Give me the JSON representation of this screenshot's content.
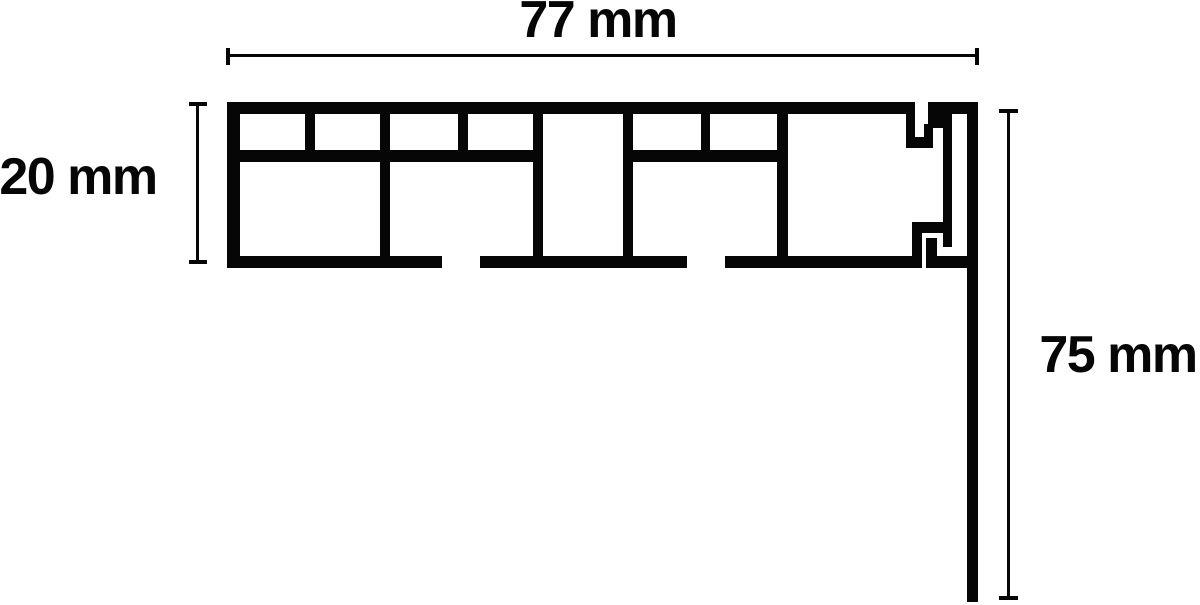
{
  "drawing": {
    "type": "technical-cross-section",
    "units": "mm",
    "ink": "#060606",
    "bg": "#ffffff",
    "profile_rects": [
      [
        227,
        102,
        688,
        12,
        "top-wall"
      ],
      [
        227,
        102,
        13,
        166,
        "left-wall"
      ],
      [
        240,
        150,
        293,
        12,
        "middle-wall-segment-1"
      ],
      [
        633,
        150,
        144,
        12,
        "middle-wall-segment-2"
      ],
      [
        227,
        256,
        215,
        12,
        "bottom-wall-segment-1"
      ],
      [
        480,
        256,
        207,
        12,
        "bottom-wall-segment-2"
      ],
      [
        725,
        256,
        197,
        12,
        "bottom-wall-segment-3"
      ],
      [
        926,
        256,
        52,
        12,
        "bottom-wall-segment-4"
      ],
      [
        305,
        114,
        10,
        48,
        "top-row-divider-1"
      ],
      [
        380,
        114,
        10,
        142,
        "full-divider-1"
      ],
      [
        458,
        114,
        10,
        48,
        "top-row-divider-2"
      ],
      [
        533,
        114,
        10,
        142,
        "center-channel-wall-left"
      ],
      [
        623,
        114,
        10,
        142,
        "center-channel-wall-right"
      ],
      [
        701,
        114,
        9,
        48,
        "top-row-divider-3"
      ],
      [
        777,
        114,
        11,
        142,
        "full-divider-2"
      ],
      [
        906,
        114,
        9,
        34,
        "hook-top-leg"
      ],
      [
        906,
        137,
        27,
        11,
        "hook-top-ledge"
      ],
      [
        924,
        124,
        9,
        24,
        "hook-up-bar"
      ],
      [
        928,
        102,
        24,
        26,
        "end-cap-block"
      ],
      [
        928,
        102,
        50,
        12,
        "end-cap-top-wall"
      ],
      [
        943,
        126,
        9,
        121,
        "end-cap-inner-bar"
      ],
      [
        967,
        114,
        11,
        488,
        "side-panel-descender"
      ],
      [
        912,
        222,
        10,
        46,
        "foot-step"
      ],
      [
        912,
        222,
        40,
        11,
        "foot-ledge"
      ],
      [
        926,
        238,
        11,
        18,
        "foot-stub"
      ]
    ],
    "dimension_rects": [
      [
        227,
        54,
        751,
        3,
        "width-dim-line"
      ],
      [
        226,
        48,
        4,
        17,
        "width-dim-tick-left"
      ],
      [
        975,
        48,
        4,
        17,
        "width-dim-tick-right"
      ],
      [
        196,
        104,
        3,
        158,
        "height-dim-line"
      ],
      [
        189,
        102,
        18,
        4,
        "height-dim-tick-top"
      ],
      [
        189,
        260,
        18,
        4,
        "height-dim-tick-bottom"
      ],
      [
        1007,
        111,
        3,
        487,
        "drop-dim-line"
      ],
      [
        999,
        109,
        19,
        4,
        "drop-dim-tick-top"
      ],
      [
        999,
        596,
        19,
        4,
        "drop-dim-tick-bottom"
      ]
    ]
  },
  "labels": {
    "width": {
      "text": "77 mm",
      "value_mm": 77,
      "pos": {
        "x": 598,
        "y": 20
      }
    },
    "height": {
      "text": "20 mm",
      "value_mm": 20,
      "pos": {
        "x": 78,
        "y": 177
      }
    },
    "drop": {
      "text": "75 mm",
      "value_mm": 75,
      "pos": {
        "x": 1118,
        "y": 355
      }
    }
  }
}
